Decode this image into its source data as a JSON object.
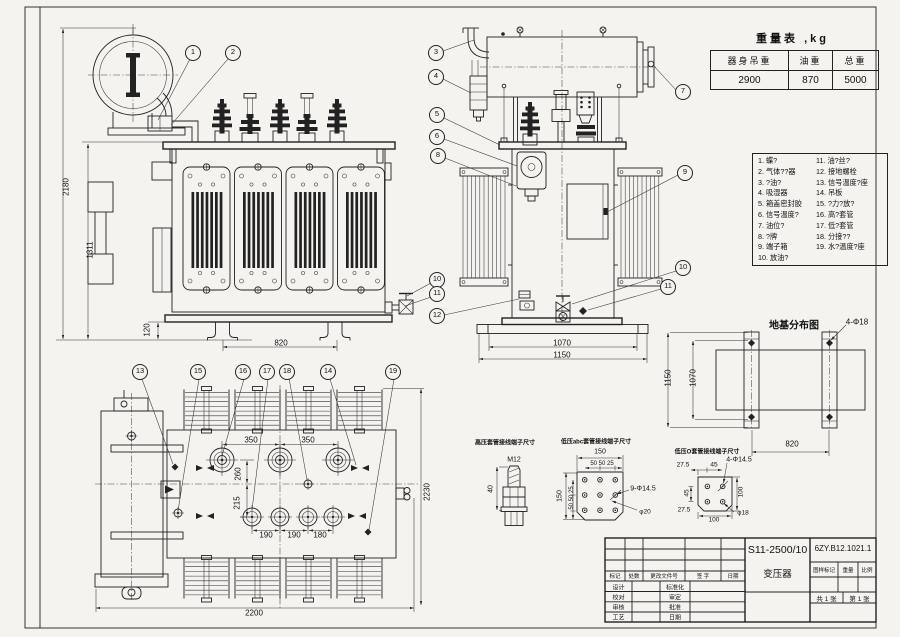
{
  "sheet": {
    "bg": "#f4f3f0",
    "line_color": "#222222"
  },
  "weight_table": {
    "title": "重量表 ,kg",
    "headers": [
      "器身吊重",
      "油重",
      "总重"
    ],
    "values": [
      "2900",
      "870",
      "5000"
    ]
  },
  "parts_list": {
    "items": [
      "1. 蝶?",
      "2. 气体??器",
      "3. ?油?",
      "4. 吸湿器",
      "5. 箱盖密封胶",
      "6. 信号温度?",
      "7. 油位?",
      "8. ?牌",
      "9. 端子箱",
      "10. 放油?",
      "11. 油?丝?",
      "12. 接地螺栓",
      "13. 信号温度?座",
      "14. 吊板",
      "15. ?力?放?",
      "16. 高?套管",
      "17. 低?套管",
      "18. 分接??",
      "19. 水?温度?座"
    ]
  },
  "callouts": [
    {
      "n": "1",
      "x": 193,
      "y": 53
    },
    {
      "n": "2",
      "x": 233,
      "y": 53
    },
    {
      "n": "3",
      "x": 436,
      "y": 53
    },
    {
      "n": "4",
      "x": 436,
      "y": 77
    },
    {
      "n": "5",
      "x": 437,
      "y": 115
    },
    {
      "n": "6",
      "x": 437,
      "y": 137
    },
    {
      "n": "7",
      "x": 683,
      "y": 92
    },
    {
      "n": "8",
      "x": 438,
      "y": 156
    },
    {
      "n": "9",
      "x": 685,
      "y": 173
    },
    {
      "n": "10",
      "x": 437,
      "y": 280
    },
    {
      "n": "11",
      "x": 437,
      "y": 294
    },
    {
      "n": "12",
      "x": 437,
      "y": 316
    },
    {
      "n": "10",
      "x": 683,
      "y": 268
    },
    {
      "n": "11",
      "x": 668,
      "y": 287
    },
    {
      "n": "13",
      "x": 140,
      "y": 372
    },
    {
      "n": "15",
      "x": 198,
      "y": 372
    },
    {
      "n": "16",
      "x": 243,
      "y": 372
    },
    {
      "n": "17",
      "x": 267,
      "y": 372
    },
    {
      "n": "18",
      "x": 287,
      "y": 372
    },
    {
      "n": "14",
      "x": 328,
      "y": 372
    },
    {
      "n": "19",
      "x": 393,
      "y": 372
    }
  ],
  "annotations": [
    {
      "t": "2180",
      "x": 66,
      "y": 187,
      "r": 1,
      "s": 8
    },
    {
      "t": "1311",
      "x": 90,
      "y": 250,
      "r": 1,
      "s": 8
    },
    {
      "t": "120",
      "x": 147,
      "y": 330,
      "r": 1,
      "s": 8
    },
    {
      "t": "820",
      "x": 281,
      "y": 343,
      "s": 8
    },
    {
      "t": "1070",
      "x": 562,
      "y": 343,
      "s": 8
    },
    {
      "t": "1150",
      "x": 562,
      "y": 355,
      "s": 8
    },
    {
      "t": "350",
      "x": 251,
      "y": 440,
      "s": 8
    },
    {
      "t": "350",
      "x": 308,
      "y": 440,
      "s": 8
    },
    {
      "t": "260",
      "x": 238,
      "y": 474,
      "r": 1,
      "s": 8
    },
    {
      "t": "215",
      "x": 237,
      "y": 503,
      "r": 1,
      "s": 8
    },
    {
      "t": "190",
      "x": 266,
      "y": 535,
      "s": 8
    },
    {
      "t": "190",
      "x": 294,
      "y": 535,
      "s": 8
    },
    {
      "t": "180",
      "x": 320,
      "y": 535,
      "s": 8
    },
    {
      "t": "2200",
      "x": 254,
      "y": 613,
      "s": 8
    },
    {
      "t": "2230",
      "x": 427,
      "y": 492,
      "r": 1,
      "s": 8
    },
    {
      "t": "地基分布图",
      "x": 794,
      "y": 324,
      "s": 10,
      "b": 1,
      "n": "foundation-plan-title"
    },
    {
      "t": "4-Φ18",
      "x": 857,
      "y": 322,
      "s": 8
    },
    {
      "t": "1150",
      "x": 668,
      "y": 378,
      "r": 1,
      "s": 8
    },
    {
      "t": "1070",
      "x": 693,
      "y": 378,
      "r": 1,
      "s": 8
    },
    {
      "t": "820",
      "x": 792,
      "y": 444,
      "s": 8
    },
    {
      "t": "高压套管接线端子尺寸",
      "x": 505,
      "y": 442,
      "s": 6,
      "b": 1,
      "n": "detail-title-hv-terminal"
    },
    {
      "t": "M12",
      "x": 514,
      "y": 460,
      "s": 7
    },
    {
      "t": "40",
      "x": 491,
      "y": 489,
      "r": 1,
      "s": 7
    },
    {
      "t": "低压abc套管接线端子尺寸",
      "x": 596,
      "y": 441,
      "s": 6,
      "b": 1,
      "n": "detail-title-lv-abc-terminal"
    },
    {
      "t": "150",
      "x": 600,
      "y": 452,
      "s": 7
    },
    {
      "t": "50 50 25",
      "x": 602,
      "y": 464,
      "s": 6
    },
    {
      "t": "150",
      "x": 560,
      "y": 496,
      "r": 1,
      "s": 7
    },
    {
      "t": "50 50 25",
      "x": 572,
      "y": 498,
      "r": 1,
      "s": 6
    },
    {
      "t": "9-Φ14.5",
      "x": 643,
      "y": 489,
      "s": 7
    },
    {
      "t": "φ20",
      "x": 645,
      "y": 512,
      "s": 6.5
    },
    {
      "t": "低压O套管接线端子尺寸",
      "x": 707,
      "y": 451,
      "s": 6,
      "b": 1,
      "n": "detail-title-lv-o-terminal"
    },
    {
      "t": "27.5",
      "x": 683,
      "y": 465,
      "s": 6.5
    },
    {
      "t": "45",
      "x": 714,
      "y": 465,
      "s": 6.5
    },
    {
      "t": "4-Φ14.5",
      "x": 739,
      "y": 460,
      "s": 7
    },
    {
      "t": "45",
      "x": 687,
      "y": 493,
      "r": 1,
      "s": 6.5
    },
    {
      "t": "27.5",
      "x": 684,
      "y": 510,
      "s": 6.5
    },
    {
      "t": "100",
      "x": 741,
      "y": 492,
      "r": 1,
      "s": 6.5
    },
    {
      "t": "100",
      "x": 714,
      "y": 520,
      "s": 6.5
    },
    {
      "t": "φ18",
      "x": 743,
      "y": 513,
      "s": 6.5
    }
  ],
  "title_block": {
    "model": "S11-2500/10",
    "product": "变压器",
    "drawing_no": "6ZY.B12.1021.1",
    "cells": [
      {
        "t": "标记",
        "x": 615,
        "y": 576,
        "s": 5.5
      },
      {
        "t": "处数",
        "x": 634,
        "y": 576,
        "s": 5.5
      },
      {
        "t": "更改文件号",
        "x": 664,
        "y": 576,
        "s": 5.5
      },
      {
        "t": "签  字",
        "x": 703,
        "y": 576,
        "s": 5.5
      },
      {
        "t": "日期",
        "x": 733,
        "y": 576,
        "s": 5.5
      },
      {
        "t": "设计",
        "x": 618.5,
        "y": 586.5,
        "s": 6
      },
      {
        "t": "校对",
        "x": 618.5,
        "y": 596.6,
        "s": 6
      },
      {
        "t": "审核",
        "x": 618.5,
        "y": 607,
        "s": 6
      },
      {
        "t": "工艺",
        "x": 618.5,
        "y": 617,
        "s": 6
      },
      {
        "t": "标准化",
        "x": 675,
        "y": 586.5,
        "s": 6
      },
      {
        "t": "审定",
        "x": 675,
        "y": 596.6,
        "s": 6
      },
      {
        "t": "批准",
        "x": 675,
        "y": 607,
        "s": 6
      },
      {
        "t": "日期",
        "x": 675,
        "y": 617,
        "s": 6
      },
      {
        "t": "图样标记",
        "x": 824,
        "y": 569.5,
        "s": 5.5
      },
      {
        "t": "重量",
        "x": 848,
        "y": 569.5,
        "s": 5.5
      },
      {
        "t": "比例",
        "x": 867,
        "y": 569.5,
        "s": 5.5
      },
      {
        "t": "共 1 张",
        "x": 826.5,
        "y": 597.5,
        "s": 6.5
      },
      {
        "t": "第 1 张",
        "x": 859.5,
        "y": 597.5,
        "s": 6.5
      }
    ]
  }
}
